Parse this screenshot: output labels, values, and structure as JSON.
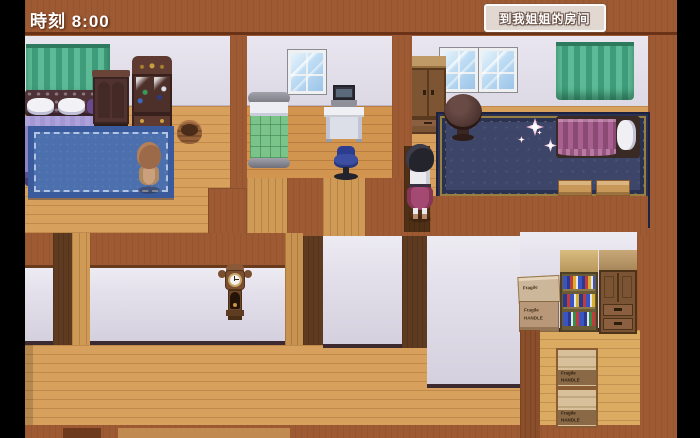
{
  "hud": {
    "time_label": "時刻 8:00",
    "quest_button_label": "到我姐姐的房间"
  },
  "storage": {
    "stencil_line1": "Fragile",
    "stencil_line2": "HANDLE"
  },
  "colors": {
    "wall_brown": "#9d5a33",
    "dark_wall": "#5d3a20",
    "floor_tan": "#d7a05c",
    "wall_face_white": "#e2deea",
    "rug_left_blue": "#4c6fae",
    "rug_right_navy": "#3d4568",
    "curtain_green": "#4fae8a",
    "bed_left_purple": "#8678c0",
    "bed_mid_green": "#7ac489",
    "bed_right_magenta": "#a05a88",
    "quest_button_bg": "#e2d8d2",
    "hud_text": "#ffffff",
    "star_pink": "#f4bcd8"
  },
  "scene": {
    "type": "top-down RPG interior, three bedrooms over hallways and a storage room",
    "rooms": [
      "left-bedroom",
      "middle-bedroom",
      "right-bedroom",
      "hallway",
      "storage-room"
    ],
    "characters": [
      {
        "id": "npc-brown-hair",
        "desc": "small NPC, brown bob hair, tan dress, facing north on blue rug"
      },
      {
        "id": "player-black-hair",
        "desc": "girl, black bob hair, white top, magenta skirt, standing in doorway"
      }
    ],
    "furniture": [
      "double-bed-purple",
      "wardrobe-dark",
      "display-cabinet",
      "basket",
      "green-curtain-left",
      "single-bed-green",
      "window",
      "computer-desk",
      "office-chair",
      "wardrobe-light",
      "double-window",
      "green-curtain-right",
      "round-table",
      "bed-magenta",
      "bench",
      "bench",
      "grandfather-clock",
      "cardboard-boxes",
      "bookshelf",
      "cabinet-drawers",
      "wooden-crates"
    ]
  }
}
